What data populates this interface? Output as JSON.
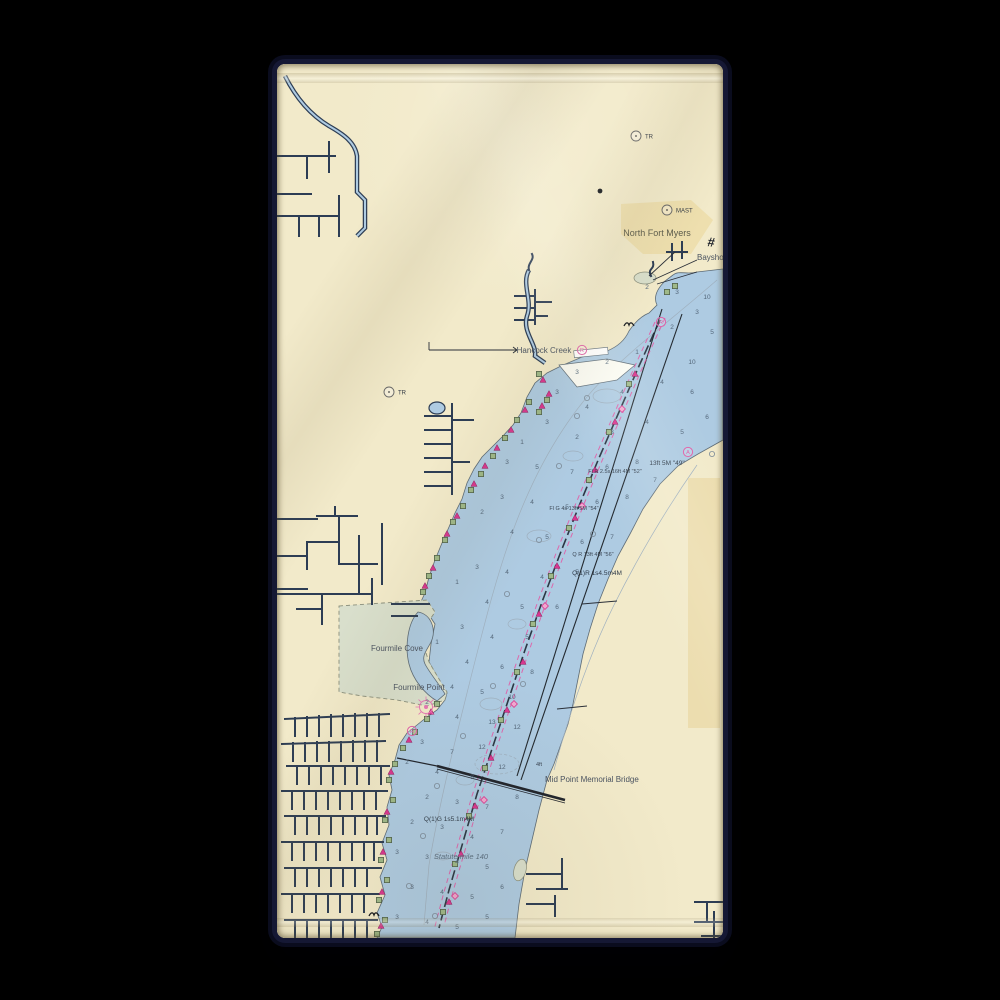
{
  "scene": {
    "product": "beach towel mockup",
    "background_color": "#000000"
  },
  "towel": {
    "base_color": "#f1e9cb",
    "edge_glow_color": "#151834"
  },
  "map": {
    "type": "nautical-chart",
    "region": "Caloosahatchee River at North Fort Myers",
    "colors": {
      "water": "#aecbe2",
      "land": "#f2eaca",
      "urban": "#ecdca6",
      "tan_strip": "#e7d49c",
      "marsh": "#d9dfcc",
      "shoal_white": "#fbfbf3",
      "canal": "#2d3d54",
      "channel_magenta": "#e457a3",
      "daybeacon_green": "#9fb989",
      "buoy_magenta": "#d9368f",
      "sounding_text": "#54677a"
    },
    "legend": {
      "daybeacon-square-icon": "green square = daybeacon",
      "nun-triangle-icon": "magenta triangle = nun buoy",
      "channel-diamond-icon": "magenta diamond = channel marker",
      "platform-circle-icon": "small circle = pile/platform",
      "pink-ring-icon": "magenta circle R = restricted/racon",
      "spoke-circle-icon": "magenta radial symbol = light",
      "station-circle-icon": "circle with dot = landmark (TR / MAST)",
      "wreck-icon": "black bird mark = wreck/snag",
      "hash-symbol": "# = quarry/crossing symbol"
    },
    "labels": [
      {
        "id": "north-fort-myers",
        "text": "North Fort Myers",
        "x": 380,
        "y": 172,
        "cls": "lbl-place",
        "anchor": "middle"
      },
      {
        "id": "bayshore-rd",
        "text": "Bayshore R",
        "x": 420,
        "y": 196,
        "cls": "lbl-place-sm",
        "anchor": "start"
      },
      {
        "id": "hancock-creek",
        "text": "Hancock Creek",
        "x": 267,
        "y": 289,
        "cls": "lbl-place-sm",
        "anchor": "middle"
      },
      {
        "id": "fourmile-cove",
        "text": "Fourmile Cove",
        "x": 120,
        "y": 587,
        "cls": "lbl-place-sm",
        "anchor": "middle"
      },
      {
        "id": "fourmile-point",
        "text": "Fourmile Point",
        "x": 142,
        "y": 626,
        "cls": "lbl-place-sm",
        "anchor": "middle"
      },
      {
        "id": "mid-point-memorial-bridge",
        "text": "Mid Point Memorial Bridge",
        "x": 268,
        "y": 718,
        "cls": "lbl-place-sm",
        "anchor": "start"
      },
      {
        "id": "statute-mile-140",
        "text": "Statute mile 140",
        "x": 184,
        "y": 795,
        "cls": "lbl-mile",
        "anchor": "middle"
      },
      {
        "id": "light-q1g",
        "text": "Q(1)G 1s5.1m4M",
        "x": 172,
        "y": 757,
        "cls": "lbl-nav",
        "anchor": "middle"
      },
      {
        "id": "light-q1r",
        "text": "Q(1)R 1s4.5m4M",
        "x": 320,
        "y": 511,
        "cls": "lbl-nav",
        "anchor": "middle"
      },
      {
        "id": "light-qr13",
        "text": "Q R 13ft 4M \"56\"",
        "x": 316,
        "y": 492,
        "cls": "lbl-nav-sm",
        "anchor": "middle"
      },
      {
        "id": "light-13ft",
        "text": "13ft 5M \"49\"",
        "x": 390,
        "y": 401,
        "cls": "lbl-nav",
        "anchor": "middle"
      },
      {
        "id": "light-flr",
        "text": "Fl R 2.5s 16ft 4M \"52\"",
        "x": 338,
        "y": 409,
        "cls": "lbl-nav-sm",
        "anchor": "middle"
      },
      {
        "id": "light-flg",
        "text": "Fl G 4s 13ft 5M \"54\"",
        "x": 297,
        "y": 446,
        "cls": "lbl-nav-sm",
        "anchor": "middle"
      },
      {
        "id": "bridge-clearance",
        "text": "4ft",
        "x": 262,
        "y": 702,
        "cls": "lbl-nav-sm",
        "anchor": "middle"
      }
    ],
    "stations": [
      {
        "x": 359,
        "y": 72,
        "label": "TR"
      },
      {
        "x": 112,
        "y": 328,
        "label": "TR"
      },
      {
        "x": 390,
        "y": 146,
        "label": "MAST"
      }
    ],
    "depths": [
      [
        370,
        225,
        "2"
      ],
      [
        400,
        230,
        "3"
      ],
      [
        420,
        250,
        "3"
      ],
      [
        435,
        270,
        "5"
      ],
      [
        395,
        265,
        "2"
      ],
      [
        360,
        290,
        "1"
      ],
      [
        330,
        300,
        "2"
      ],
      [
        300,
        310,
        "3"
      ],
      [
        280,
        330,
        "3"
      ],
      [
        310,
        345,
        "4"
      ],
      [
        345,
        330,
        "4"
      ],
      [
        385,
        320,
        "4"
      ],
      [
        415,
        330,
        "6"
      ],
      [
        430,
        355,
        "6"
      ],
      [
        405,
        370,
        "5"
      ],
      [
        370,
        360,
        "4"
      ],
      [
        335,
        370,
        "3"
      ],
      [
        300,
        375,
        "2"
      ],
      [
        270,
        360,
        "3"
      ],
      [
        245,
        380,
        "1"
      ],
      [
        230,
        400,
        "3"
      ],
      [
        260,
        405,
        "5"
      ],
      [
        295,
        410,
        "7"
      ],
      [
        330,
        405,
        "6"
      ],
      [
        360,
        400,
        "8"
      ],
      [
        378,
        418,
        "7"
      ],
      [
        350,
        435,
        "8"
      ],
      [
        320,
        440,
        "6"
      ],
      [
        290,
        445,
        "5"
      ],
      [
        255,
        440,
        "4"
      ],
      [
        225,
        435,
        "3"
      ],
      [
        205,
        450,
        "2"
      ],
      [
        235,
        470,
        "4"
      ],
      [
        270,
        475,
        "5"
      ],
      [
        305,
        480,
        "6"
      ],
      [
        335,
        475,
        "7"
      ],
      [
        300,
        510,
        "5"
      ],
      [
        265,
        515,
        "4"
      ],
      [
        230,
        510,
        "4"
      ],
      [
        200,
        505,
        "3"
      ],
      [
        180,
        520,
        "1"
      ],
      [
        210,
        540,
        "4"
      ],
      [
        245,
        545,
        "5"
      ],
      [
        280,
        545,
        "6"
      ],
      [
        250,
        575,
        "5"
      ],
      [
        215,
        575,
        "4"
      ],
      [
        185,
        565,
        "3"
      ],
      [
        160,
        580,
        "1"
      ],
      [
        190,
        600,
        "4"
      ],
      [
        225,
        605,
        "6"
      ],
      [
        255,
        610,
        "8"
      ],
      [
        235,
        635,
        "10"
      ],
      [
        205,
        630,
        "5"
      ],
      [
        175,
        625,
        "4"
      ],
      [
        150,
        640,
        "2"
      ],
      [
        180,
        655,
        "4"
      ],
      [
        215,
        660,
        "13"
      ],
      [
        240,
        665,
        "12"
      ],
      [
        205,
        685,
        "12"
      ],
      [
        175,
        690,
        "7"
      ],
      [
        145,
        680,
        "3"
      ],
      [
        130,
        700,
        "2"
      ],
      [
        160,
        710,
        "4"
      ],
      [
        195,
        715,
        "8"
      ],
      [
        225,
        705,
        "12"
      ],
      [
        150,
        735,
        "2"
      ],
      [
        180,
        740,
        "3"
      ],
      [
        210,
        745,
        "7"
      ],
      [
        240,
        735,
        "8"
      ],
      [
        135,
        760,
        "2"
      ],
      [
        165,
        765,
        "3"
      ],
      [
        195,
        775,
        "4"
      ],
      [
        225,
        770,
        "7"
      ],
      [
        120,
        790,
        "3"
      ],
      [
        150,
        795,
        "3"
      ],
      [
        180,
        800,
        "4"
      ],
      [
        210,
        805,
        "5"
      ],
      [
        135,
        825,
        "3"
      ],
      [
        165,
        830,
        "4"
      ],
      [
        195,
        835,
        "5"
      ],
      [
        225,
        825,
        "6"
      ],
      [
        120,
        855,
        "3"
      ],
      [
        150,
        860,
        "4"
      ],
      [
        180,
        865,
        "5"
      ],
      [
        210,
        855,
        "5"
      ],
      [
        415,
        300,
        "10"
      ],
      [
        430,
        235,
        "10"
      ]
    ],
    "markers": {
      "squares": [
        [
          252,
          338
        ],
        [
          240,
          356
        ],
        [
          228,
          374
        ],
        [
          216,
          392
        ],
        [
          204,
          410
        ],
        [
          194,
          426
        ],
        [
          186,
          442
        ],
        [
          176,
          458
        ],
        [
          168,
          476
        ],
        [
          160,
          494
        ],
        [
          152,
          512
        ],
        [
          146,
          528
        ],
        [
          160,
          640
        ],
        [
          150,
          655
        ],
        [
          138,
          668
        ],
        [
          126,
          684
        ],
        [
          118,
          700
        ],
        [
          112,
          716
        ],
        [
          116,
          736
        ],
        [
          108,
          756
        ],
        [
          112,
          776
        ],
        [
          104,
          796
        ],
        [
          110,
          816
        ],
        [
          102,
          836
        ],
        [
          108,
          856
        ],
        [
          100,
          870
        ],
        [
          352,
          320
        ],
        [
          332,
          368
        ],
        [
          312,
          416
        ],
        [
          292,
          464
        ],
        [
          274,
          512
        ],
        [
          256,
          560
        ],
        [
          240,
          608
        ],
        [
          224,
          656
        ],
        [
          208,
          704
        ],
        [
          192,
          752
        ],
        [
          178,
          800
        ],
        [
          166,
          848
        ],
        [
          262,
          310
        ],
        [
          270,
          336
        ],
        [
          262,
          348
        ],
        [
          398,
          222
        ],
        [
          390,
          228
        ]
      ],
      "triangles": [
        [
          248,
          346
        ],
        [
          234,
          366
        ],
        [
          220,
          384
        ],
        [
          208,
          402
        ],
        [
          197,
          420
        ],
        [
          180,
          452
        ],
        [
          170,
          470
        ],
        [
          156,
          504
        ],
        [
          148,
          522
        ],
        [
          154,
          648
        ],
        [
          132,
          676
        ],
        [
          114,
          708
        ],
        [
          110,
          748
        ],
        [
          106,
          788
        ],
        [
          105,
          828
        ],
        [
          104,
          862
        ],
        [
          358,
          310
        ],
        [
          338,
          358
        ],
        [
          318,
          406
        ],
        [
          298,
          454
        ],
        [
          280,
          502
        ],
        [
          262,
          550
        ],
        [
          246,
          598
        ],
        [
          230,
          646
        ],
        [
          214,
          694
        ],
        [
          198,
          742
        ],
        [
          184,
          790
        ],
        [
          172,
          838
        ],
        [
          266,
          316
        ],
        [
          272,
          330
        ],
        [
          265,
          342
        ]
      ],
      "diamonds": [
        [
          345,
          345
        ],
        [
          305,
          442
        ],
        [
          268,
          542
        ],
        [
          237,
          640
        ],
        [
          207,
          736
        ],
        [
          178,
          832
        ]
      ],
      "circles": [
        [
          300,
          352
        ],
        [
          282,
          402
        ],
        [
          316,
          470
        ],
        [
          262,
          476
        ],
        [
          230,
          530
        ],
        [
          246,
          620
        ],
        [
          216,
          622
        ],
        [
          186,
          672
        ],
        [
          160,
          722
        ],
        [
          146,
          772
        ],
        [
          132,
          822
        ],
        [
          158,
          852
        ],
        [
          435,
          390
        ],
        [
          310,
          334
        ]
      ],
      "rings": [
        {
          "x": 305,
          "y": 286,
          "letter": "R"
        },
        {
          "x": 384,
          "y": 258,
          "letter": "R"
        },
        {
          "x": 411,
          "y": 388,
          "letter": "A"
        },
        {
          "x": 135,
          "y": 667,
          "letter": "R"
        }
      ],
      "spokes": [
        [
          149,
          643
        ]
      ],
      "dots": [
        [
          323,
          127
        ]
      ],
      "wrecks": [
        [
          352,
          262
        ],
        [
          97,
          852
        ]
      ]
    },
    "hash_symbol": {
      "text": "#",
      "x": 430,
      "y": 182
    }
  }
}
